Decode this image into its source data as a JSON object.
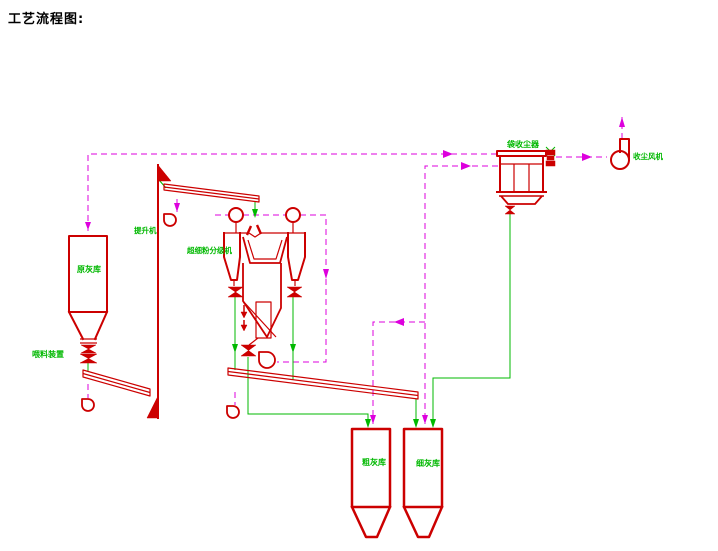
{
  "title": "工艺流程图:",
  "colors": {
    "line_red": "#cc0000",
    "line_green": "#00b800",
    "line_magenta": "#dd00dd",
    "title_black": "#000000",
    "background": "#ffffff"
  },
  "equipment": {
    "raw_ash_silo": {
      "label": "原灰库"
    },
    "feeding_device": {
      "label": "喂料装置"
    },
    "elevator": {
      "label": "提升机"
    },
    "classifier": {
      "label": "超细粉分级机"
    },
    "bag_dust_collector": {
      "label": "袋收尘器"
    },
    "dust_fan": {
      "label": "收尘风机"
    },
    "coarse_ash_silo": {
      "label": "粗灰库"
    },
    "fine_ash_silo": {
      "label": "细灰库"
    }
  }
}
